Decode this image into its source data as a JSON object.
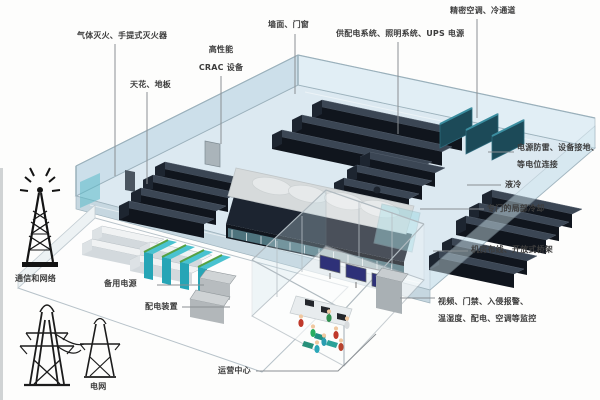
{
  "callouts": {
    "fire_suppression": "气体灭火、手提式灭火器",
    "crac": {
      "line1": "高性能",
      "line2": "CRAC 设备"
    },
    "ceiling_floor": "天花、地板",
    "walls_doors_windows": "墙面、门窗",
    "power_lighting_ups": "供配电系统、照明系统、UPS 电源",
    "precision_ac_cold_aisle": "精密空调、冷通道",
    "grounding": {
      "line1": "电源防雷、设备接地、",
      "line2": "等电位连接"
    },
    "liquid_cooling": "液冷",
    "dedicated_local_cooling": "专门的局部冷却",
    "cabling_tray": "机房布线、开放式桥架",
    "monitoring": {
      "line1": "视频、门禁、入侵报警、",
      "line2": "温湿度、配电、空调等监控"
    },
    "operations_center": "运营中心",
    "backup_power": "备用电源",
    "power_distribution": "配电装置",
    "telecom_network": "通信和网络",
    "power_grid": "电网"
  },
  "icons": {
    "telecom": "radio-tower-icon",
    "grid": "transmission-towers-icon"
  },
  "colors": {
    "background": "#ffffff",
    "floor": "#dce9f1",
    "wall": "#c8dde9",
    "rack_dark": "#10151d",
    "rack_top": "#3b4654",
    "containment_roof": "#d6dadb",
    "glass_teal": "#7fccd8",
    "battery_teal": "#2aadbf",
    "battery_green": "#55a043",
    "screen_navy": "#2e3178",
    "label_text": "#3d3d3d",
    "leader_line": "#8a8f93"
  }
}
